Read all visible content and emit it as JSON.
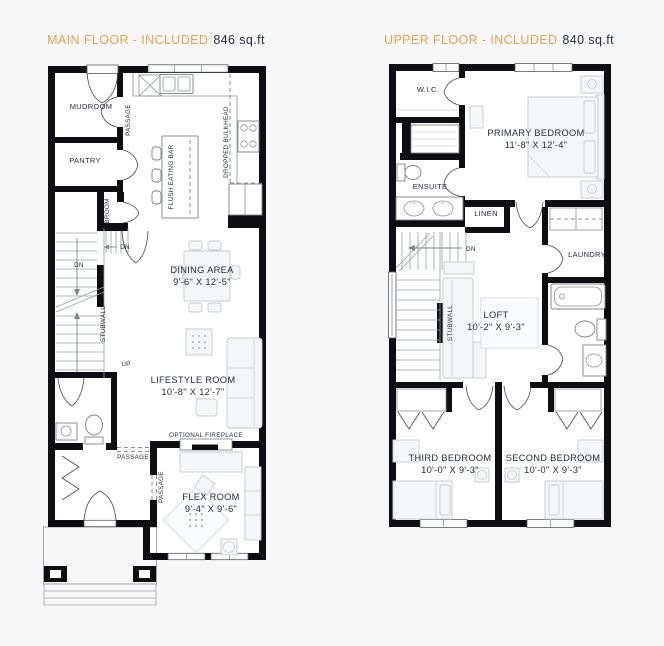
{
  "colors": {
    "background": "#f7f7f7",
    "wall": "#0e0e12",
    "accent_orange": "#E8A14D",
    "navy": "#232C4E",
    "label": "#262A3C",
    "furniture": "#c6c9cd"
  },
  "plans": [
    {
      "id": "main-floor",
      "title": "MAIN FLOOR - INCLUDED",
      "area": "846 sq.ft",
      "labels": {
        "mudroom": "MUDROOM",
        "passage_top": "PASSAGE",
        "pantry": "PANTRY",
        "broom": "BROOM",
        "dn_upper": "DN",
        "dn_lower": "DN",
        "up": "UP",
        "stubwall": "STUBWALL",
        "flush_eating_bar": "FLUSH EATING BAR",
        "dropped_bulkhead": "DROPPED BULKHEAD",
        "dining_area": "DINING AREA",
        "dining_dims": "9'-6\" X 12'-5\"",
        "lifestyle_room": "LIFESTYLE ROOM",
        "lifestyle_dims": "10'-8\" X 12'-7\"",
        "optional_fireplace": "OPTIONAL FIREPLACE",
        "passage_mid": "PASSAGE",
        "passage_flex": "PASSAGE",
        "flex_room": "FLEX ROOM",
        "flex_dims": "9'-4\" X 9'-6\""
      }
    },
    {
      "id": "upper-floor",
      "title": "UPPER FLOOR - INCLUDED",
      "area": "840 sq.ft",
      "labels": {
        "wic": "W.I.C.",
        "ensuite": "ENSUITE",
        "primary_bedroom": "PRIMARY BEDROOM",
        "primary_dims": "11'-8\" X 12'-4\"",
        "linen": "LINEN",
        "dn": "DN",
        "laundry": "LAUNDRY",
        "stubwall": "STUBWALL",
        "loft": "LOFT",
        "loft_dims": "10'-2\" X 9'-3\"",
        "third_bedroom": "THIRD BEDROOM",
        "third_dims": "10'-0\" X 9'-3\"",
        "second_bedroom": "SECOND BEDROOM",
        "second_dims": "10'-0\" X 9'-3\""
      }
    }
  ]
}
